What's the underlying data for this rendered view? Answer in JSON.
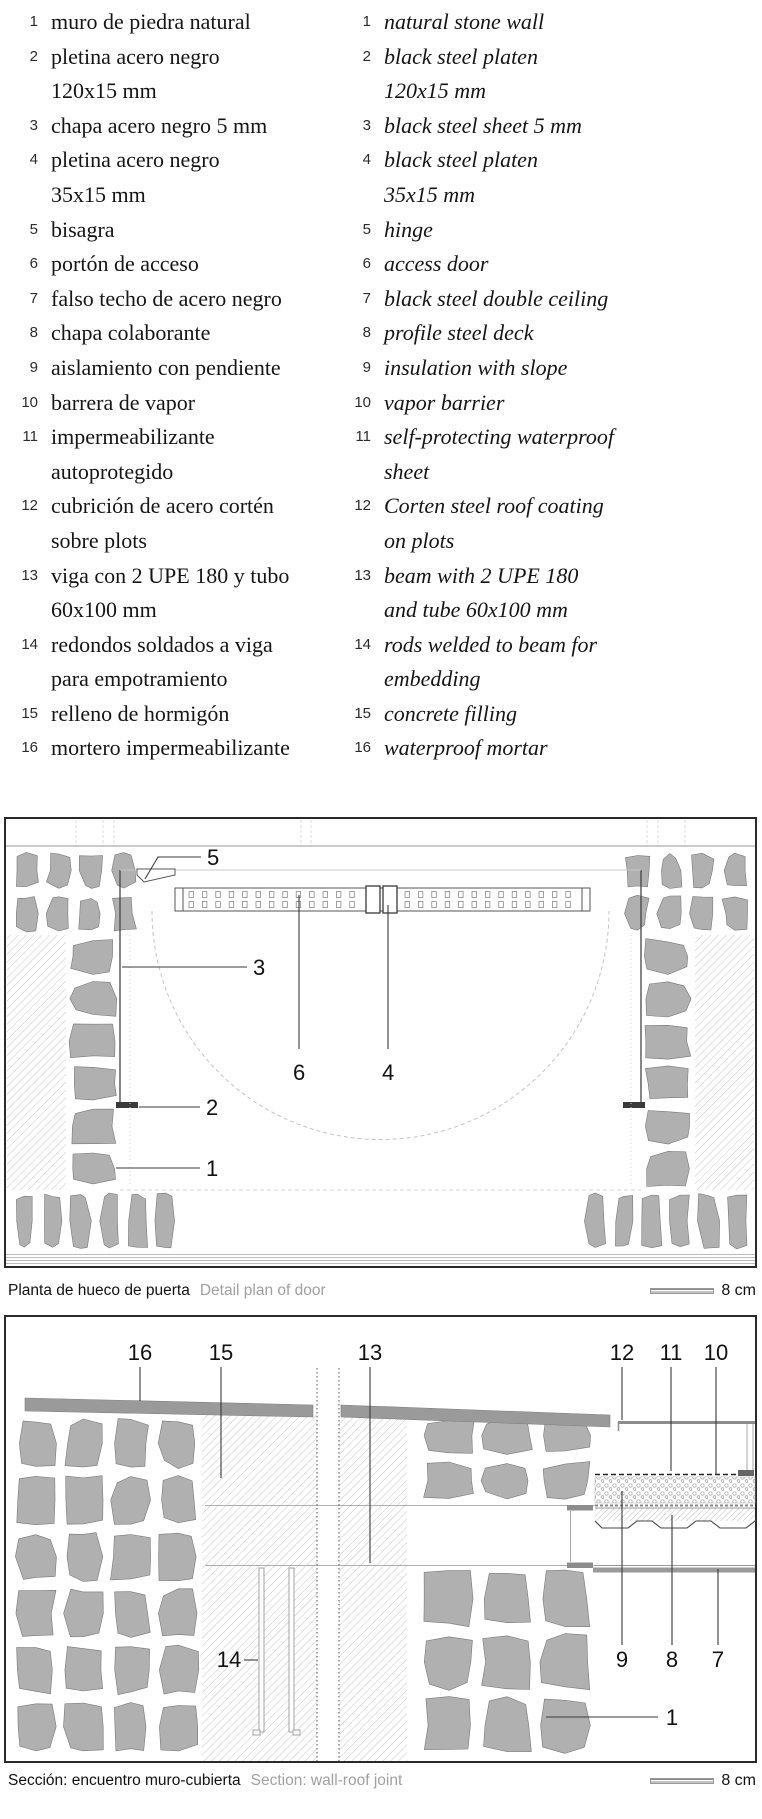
{
  "legend": {
    "items": [
      {
        "n": "1",
        "es": "muro de piedra natural",
        "en": "natural stone wall"
      },
      {
        "n": "2",
        "es": "pletina acero negro\n120x15 mm",
        "en": "black steel platen\n120x15 mm"
      },
      {
        "n": "3",
        "es": "chapa acero negro 5 mm",
        "en": "black steel sheet 5 mm"
      },
      {
        "n": "4",
        "es": "pletina acero negro\n35x15 mm",
        "en": "black steel platen\n35x15 mm"
      },
      {
        "n": "5",
        "es": "bisagra",
        "en": "hinge"
      },
      {
        "n": "6",
        "es": "portón de acceso",
        "en": "access door"
      },
      {
        "n": "7",
        "es": "falso techo de acero negro",
        "en": "black steel double ceiling"
      },
      {
        "n": "8",
        "es": "chapa colaborante",
        "en": "profile steel deck"
      },
      {
        "n": "9",
        "es": "aislamiento con pendiente",
        "en": "insulation with slope"
      },
      {
        "n": "10",
        "es": "barrera de vapor",
        "en": "vapor barrier"
      },
      {
        "n": "11",
        "es": "impermeabilizante\nautoprotegido",
        "en": "self-protecting waterproof\nsheet"
      },
      {
        "n": "12",
        "es": "cubrición de acero cortén\nsobre plots",
        "en": "Corten steel roof coating\non plots"
      },
      {
        "n": "13",
        "es": "viga con 2 UPE 180 y tubo\n60x100 mm",
        "en": "beam with 2 UPE 180\nand tube 60x100 mm"
      },
      {
        "n": "14",
        "es": "redondos soldados a viga\npara empotramiento",
        "en": "rods welded to beam for\nembedding"
      },
      {
        "n": "15",
        "es": "relleno de hormigón",
        "en": "concrete filling"
      },
      {
        "n": "16",
        "es": "mortero impermeabilizante",
        "en": "waterproof mortar"
      }
    ]
  },
  "plan": {
    "caption_es": "Planta de hueco de puerta",
    "caption_en": "Detail plan of door",
    "scale": "8 cm",
    "callouts": {
      "hinge": "5",
      "sheet": "3",
      "door": "6",
      "platen4": "4",
      "platen2": "2",
      "wall": "1"
    }
  },
  "section": {
    "caption_es": "Sección: encuentro muro-cubierta",
    "caption_en": "Section: wall-roof joint",
    "scale": "8 cm",
    "callouts": {
      "mortar": "16",
      "filling": "15",
      "beam": "13",
      "corten": "12",
      "waterproof": "11",
      "vapor": "10",
      "insulation": "9",
      "deck": "8",
      "ceiling": "7",
      "rods": "14",
      "wall": "1"
    }
  },
  "colors": {
    "stone": "#b0b0b0",
    "stone_edge": "#787878",
    "coping": "#9a9a9a",
    "caption_gray": "#a0a0a0",
    "ink": "#1a1a1a",
    "hatch": "#c6c6c6"
  }
}
